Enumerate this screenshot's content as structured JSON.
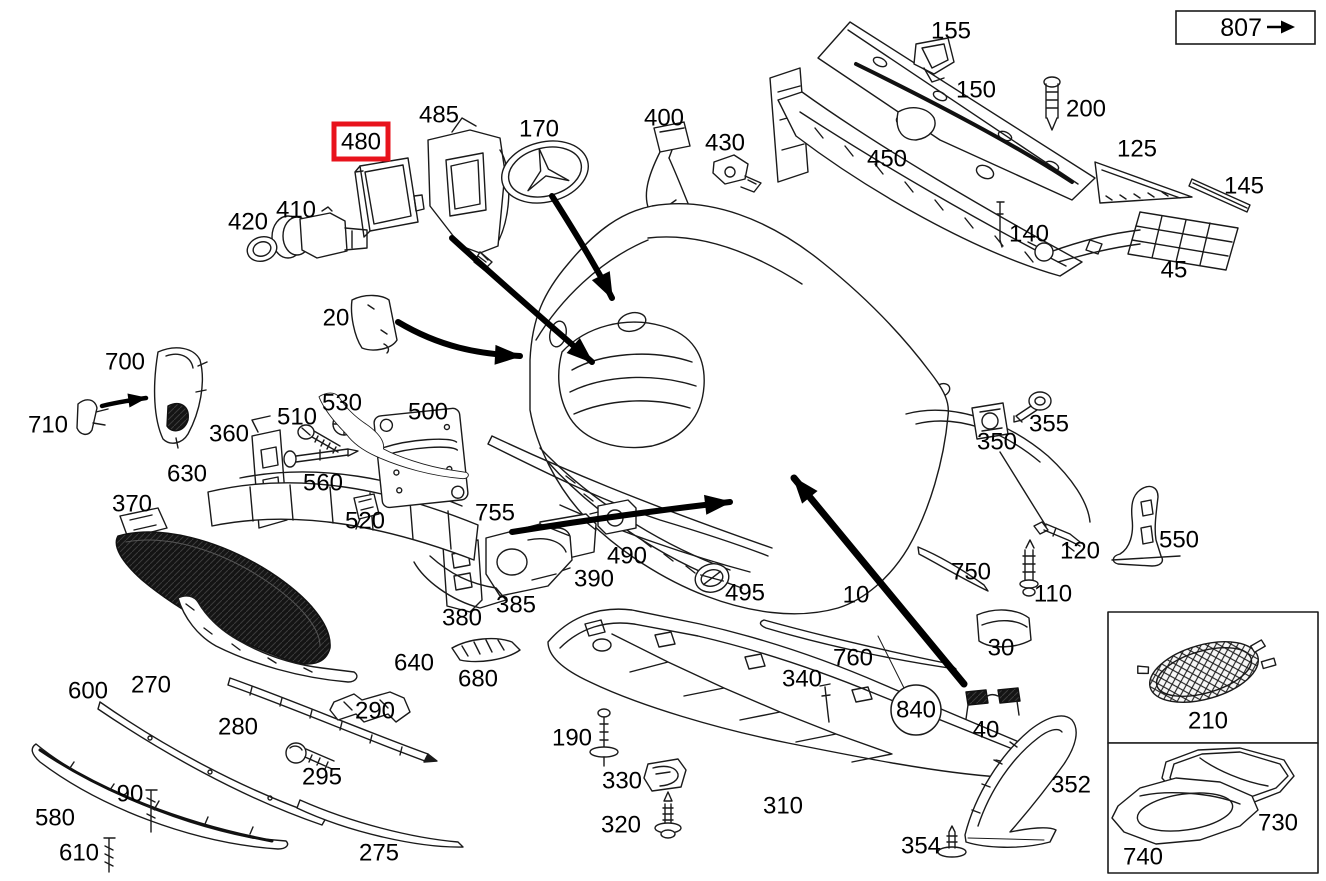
{
  "diagram": {
    "background_color": "#ffffff",
    "line_color": "#1a1a1a",
    "highlight_color": "#e8131c",
    "text_color": "#000000",
    "highlighted_part": "480",
    "ballooned_part": "840",
    "arrow_icon": "right-arrow"
  },
  "reference_link": {
    "label": "807"
  },
  "inset_panels": [
    {
      "parts": [
        "210"
      ]
    },
    {
      "parts": [
        "730",
        "740"
      ]
    }
  ],
  "parts": [
    {
      "label": "155",
      "x": 951,
      "y": 31
    },
    {
      "label": "150",
      "x": 976,
      "y": 90
    },
    {
      "label": "200",
      "x": 1086,
      "y": 109
    },
    {
      "label": "125",
      "x": 1137,
      "y": 149
    },
    {
      "label": "145",
      "x": 1244,
      "y": 186
    },
    {
      "label": "450",
      "x": 887,
      "y": 159
    },
    {
      "label": "140",
      "x": 1029,
      "y": 234
    },
    {
      "label": "45",
      "x": 1174,
      "y": 270
    },
    {
      "label": "400",
      "x": 664,
      "y": 118
    },
    {
      "label": "430",
      "x": 725,
      "y": 143
    },
    {
      "label": "485",
      "x": 439,
      "y": 115
    },
    {
      "label": "480",
      "x": 361,
      "y": 142,
      "marker": "red-box"
    },
    {
      "label": "170",
      "x": 539,
      "y": 129
    },
    {
      "label": "420",
      "x": 248,
      "y": 222
    },
    {
      "label": "410",
      "x": 296,
      "y": 210
    },
    {
      "label": "20",
      "x": 336,
      "y": 318
    },
    {
      "label": "700",
      "x": 125,
      "y": 362
    },
    {
      "label": "710",
      "x": 48,
      "y": 425
    },
    {
      "label": "360",
      "x": 229,
      "y": 434
    },
    {
      "label": "510",
      "x": 297,
      "y": 417
    },
    {
      "label": "530",
      "x": 342,
      "y": 403
    },
    {
      "label": "500",
      "x": 428,
      "y": 412
    },
    {
      "label": "630",
      "x": 187,
      "y": 474
    },
    {
      "label": "560",
      "x": 323,
      "y": 483
    },
    {
      "label": "520",
      "x": 365,
      "y": 521
    },
    {
      "label": "370",
      "x": 132,
      "y": 504
    },
    {
      "label": "755",
      "x": 495,
      "y": 513
    },
    {
      "label": "490",
      "x": 627,
      "y": 556
    },
    {
      "label": "390",
      "x": 594,
      "y": 579
    },
    {
      "label": "385",
      "x": 516,
      "y": 605
    },
    {
      "label": "380",
      "x": 462,
      "y": 618
    },
    {
      "label": "495",
      "x": 745,
      "y": 593
    },
    {
      "label": "10",
      "x": 856,
      "y": 595
    },
    {
      "label": "750",
      "x": 971,
      "y": 572
    },
    {
      "label": "120",
      "x": 1080,
      "y": 551
    },
    {
      "label": "110",
      "x": 1053,
      "y": 594
    },
    {
      "label": "550",
      "x": 1179,
      "y": 540
    },
    {
      "label": "350",
      "x": 997,
      "y": 442
    },
    {
      "label": "355",
      "x": 1049,
      "y": 424
    },
    {
      "label": "640",
      "x": 414,
      "y": 663
    },
    {
      "label": "680",
      "x": 478,
      "y": 679
    },
    {
      "label": "600",
      "x": 88,
      "y": 691
    },
    {
      "label": "270",
      "x": 151,
      "y": 685
    },
    {
      "label": "280",
      "x": 238,
      "y": 727
    },
    {
      "label": "290",
      "x": 375,
      "y": 711
    },
    {
      "label": "295",
      "x": 322,
      "y": 777
    },
    {
      "label": "90",
      "x": 130,
      "y": 794
    },
    {
      "label": "580",
      "x": 55,
      "y": 818
    },
    {
      "label": "610",
      "x": 79,
      "y": 853
    },
    {
      "label": "275",
      "x": 379,
      "y": 853
    },
    {
      "label": "190",
      "x": 572,
      "y": 738
    },
    {
      "label": "330",
      "x": 622,
      "y": 781
    },
    {
      "label": "320",
      "x": 621,
      "y": 825
    },
    {
      "label": "310",
      "x": 783,
      "y": 806
    },
    {
      "label": "340",
      "x": 802,
      "y": 679
    },
    {
      "label": "760",
      "x": 853,
      "y": 658
    },
    {
      "label": "840",
      "x": 916,
      "y": 710,
      "marker": "balloon"
    },
    {
      "label": "30",
      "x": 1001,
      "y": 648
    },
    {
      "label": "40",
      "x": 986,
      "y": 730
    },
    {
      "label": "352",
      "x": 1071,
      "y": 785
    },
    {
      "label": "354",
      "x": 921,
      "y": 846
    },
    {
      "label": "210",
      "x": 1208,
      "y": 721
    },
    {
      "label": "730",
      "x": 1278,
      "y": 823
    },
    {
      "label": "740",
      "x": 1143,
      "y": 857
    }
  ]
}
